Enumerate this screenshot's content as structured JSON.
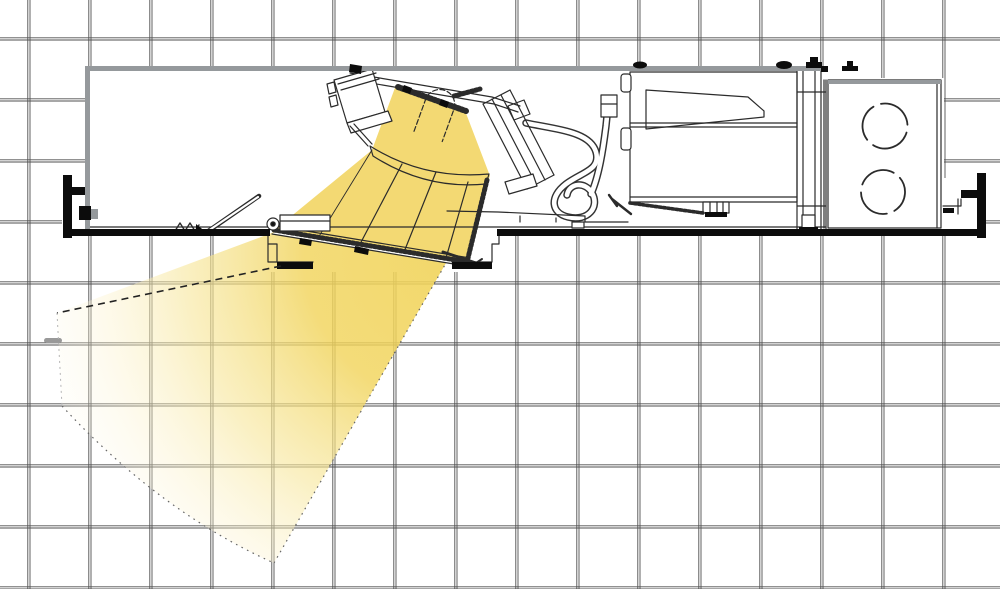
{
  "diagram": {
    "subject": "Recessed adjustable accent downlight - side section view on ceiling grid with aimed light beam",
    "visible_text": []
  },
  "colors": {
    "background": "#ffffff",
    "grid_line": "#4f4f4f",
    "line_art": "#2b2b2b",
    "metal_gray": "#95999c",
    "ink_black": "#0c0c0c",
    "marker_gray": "#999999",
    "lamp_yellow": "#F3D973",
    "beam_core": "#F1D45C",
    "beam_mid": "#F7E79E",
    "beam_soft": "#FCF3D0",
    "beam_end": "#FFFFFF"
  },
  "grid": {
    "pitch_px": 61,
    "offset_x": 27,
    "offset_y": 37,
    "style": "double-line"
  },
  "housing": {
    "x": 85,
    "y": 66,
    "width": 858,
    "height": 166
  },
  "driver_box": {
    "x": 630,
    "y": 72,
    "width": 167,
    "height": 130
  },
  "junction_box": {
    "x": 828,
    "y": 80,
    "width": 113,
    "height": 148,
    "knockouts": [
      {
        "cx": 885,
        "cy": 126,
        "r": 22.5
      },
      {
        "cx": 883,
        "cy": 192,
        "r": 22
      }
    ]
  },
  "lamp": {
    "tilt_deg": 30
  },
  "beam": {
    "path": "M277 231 L57 313 L62 406 Q160 512 274 563 L446 263 L272 234 Z",
    "edge_top": "M281 266 L57 313",
    "edge_left": "M57 313 L62 406",
    "edge_bottom": "M62 406 Q160 512 274 563",
    "edge_right": "M274 563 L446 263",
    "gradient": {
      "cx": 462,
      "cy": 250,
      "r": 480
    }
  }
}
